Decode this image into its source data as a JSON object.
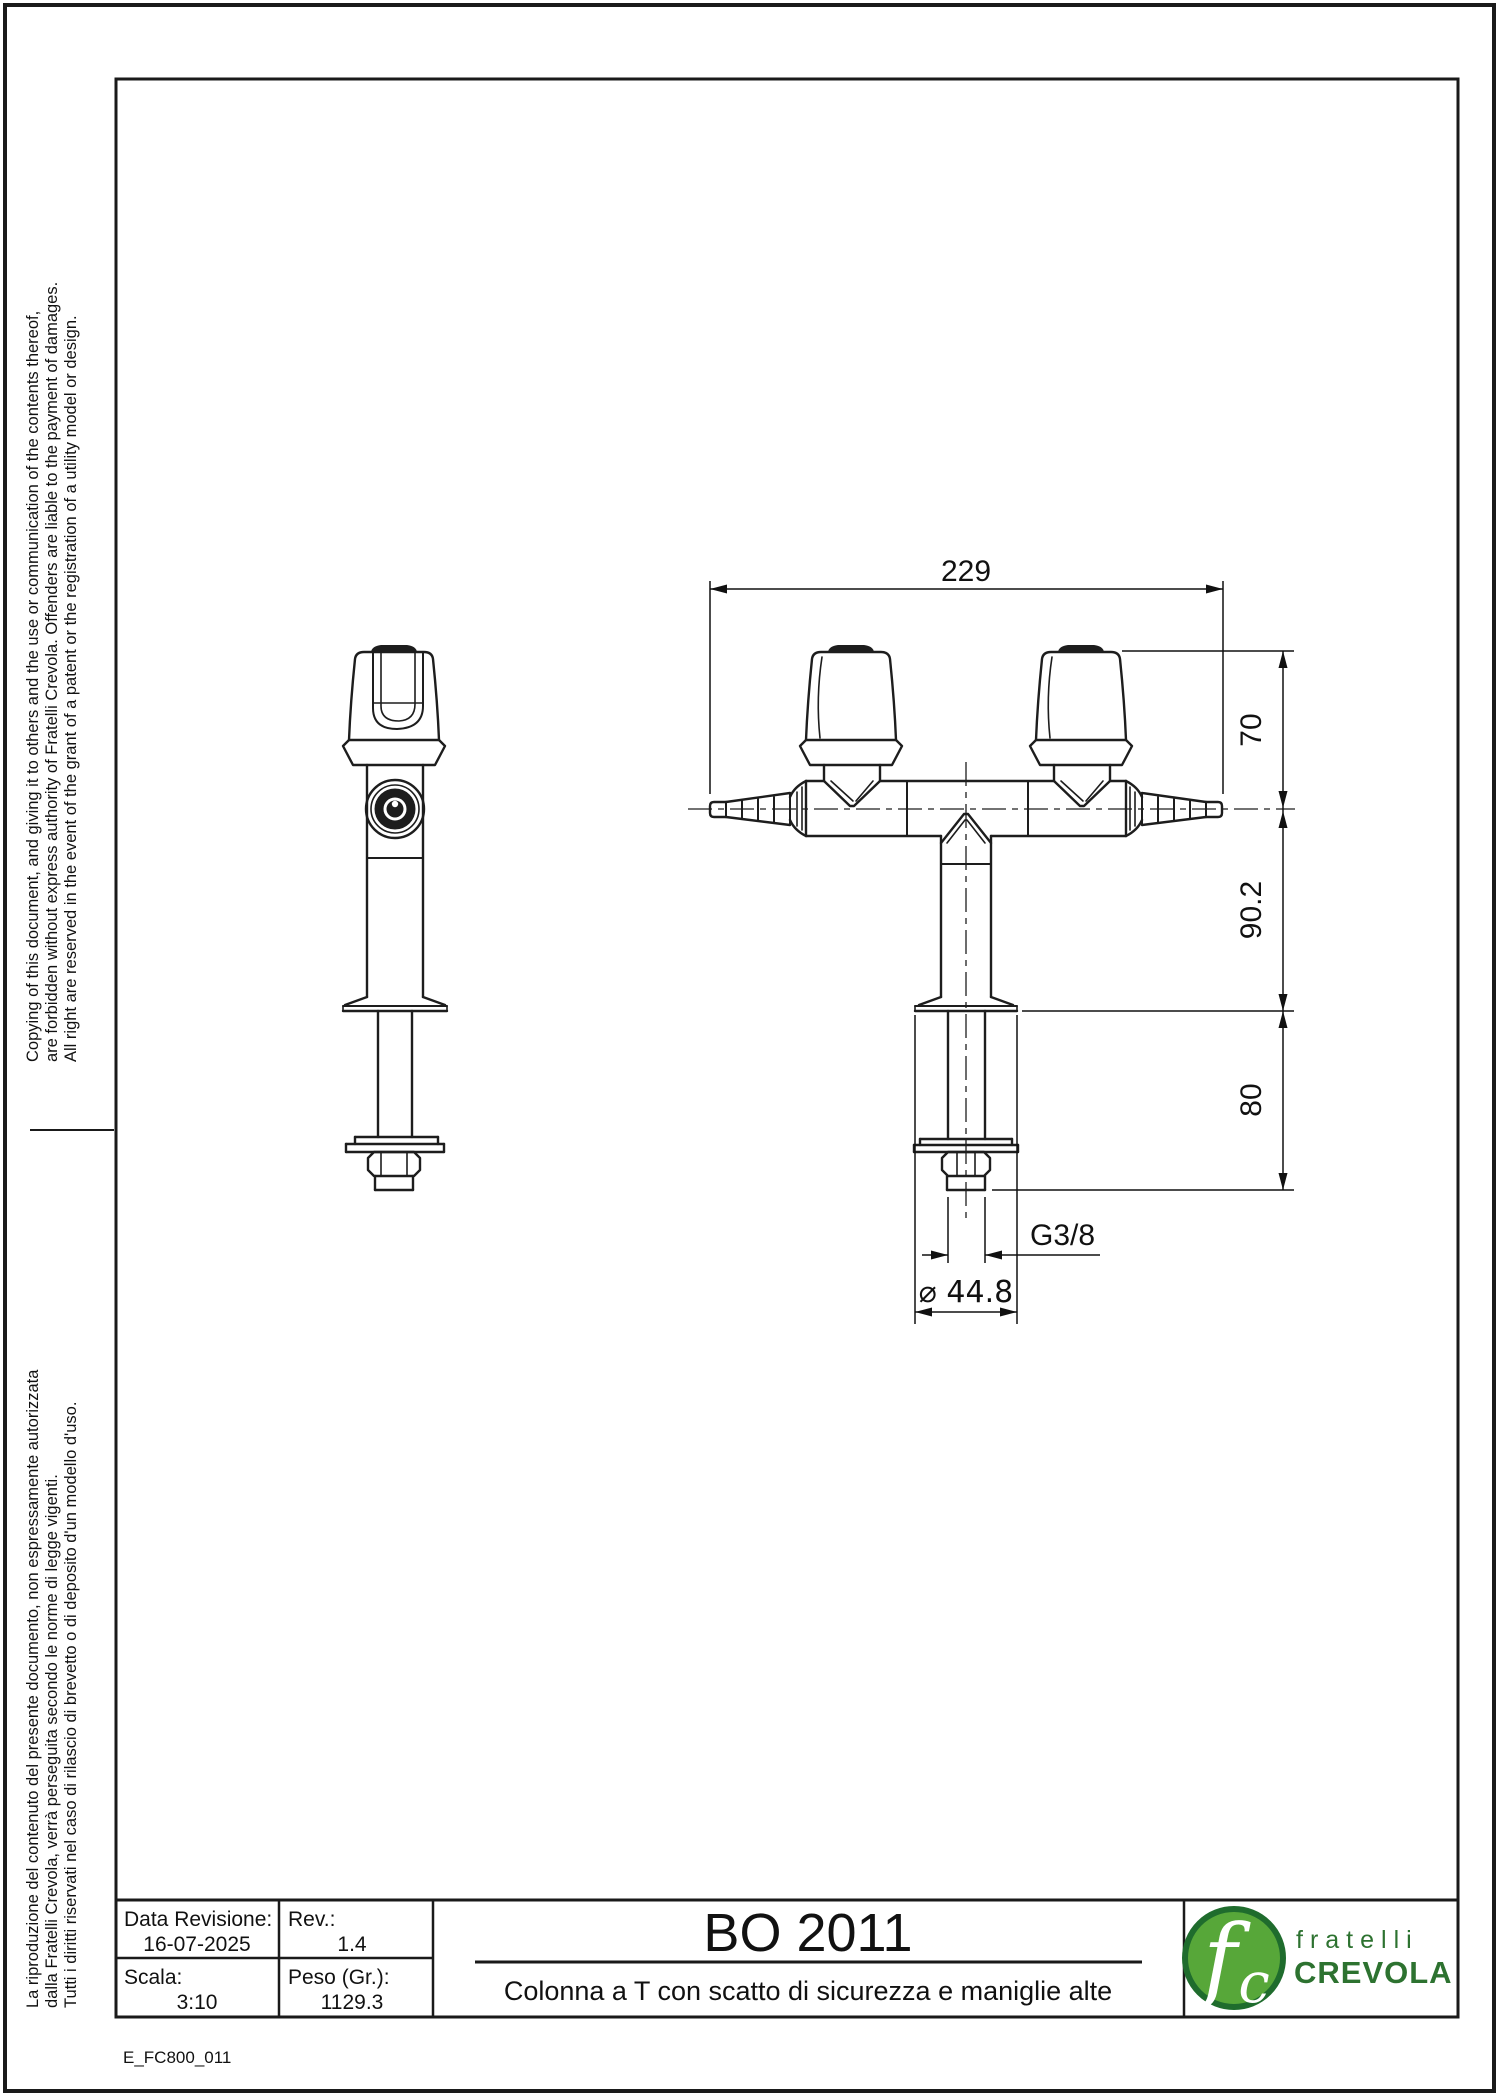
{
  "sheet": {
    "drawing_title": "BO 2011",
    "description": "Colonna a T con scatto di sicurezza e maniglie alte",
    "doc_code": "E_FC800_011",
    "title_block": {
      "rev_date_label": "Data Revisione:",
      "rev_date": "16-07-2025",
      "rev_label": "Rev.:",
      "rev": "1.4",
      "scale_label": "Scala:",
      "scale": "3:10",
      "weight_label": "Peso (Gr.):",
      "weight": "1129.3"
    },
    "logo": {
      "monogram_f": "f",
      "monogram_c": "c",
      "line1": "fratelli",
      "line2": "CREVOLA",
      "circle_fill": "#57a739",
      "circle_border": "#1f6c2d",
      "text_color": "#2d7230"
    },
    "legal": {
      "en1": "Copying of this document, and giving it to others and the use or communication of the contents thereof,",
      "en2": "are forbidden without express authority of Fratelli Crevola. Offenders are liable to the payment of damages.",
      "en3": "All right are reserved in the event of the grant of a patent or the registration of a utility model or design.",
      "it1": "La riproduzione del contenuto del presente documento, non espressamente autorizzata",
      "it2": "dalla Fratelli Crevola, verrà perseguita secondo le norme di legge vigenti.",
      "it3": "Tutti i diritti riservati nel caso di rilascio di brevetto o di deposito d'un modello d'uso."
    },
    "dimensions": {
      "width_total": "229",
      "handle_height": "70",
      "body_height": "90.2",
      "shank_length": "80",
      "thread": "G3/8",
      "flange_diameter": "⌀ 44.8"
    }
  }
}
